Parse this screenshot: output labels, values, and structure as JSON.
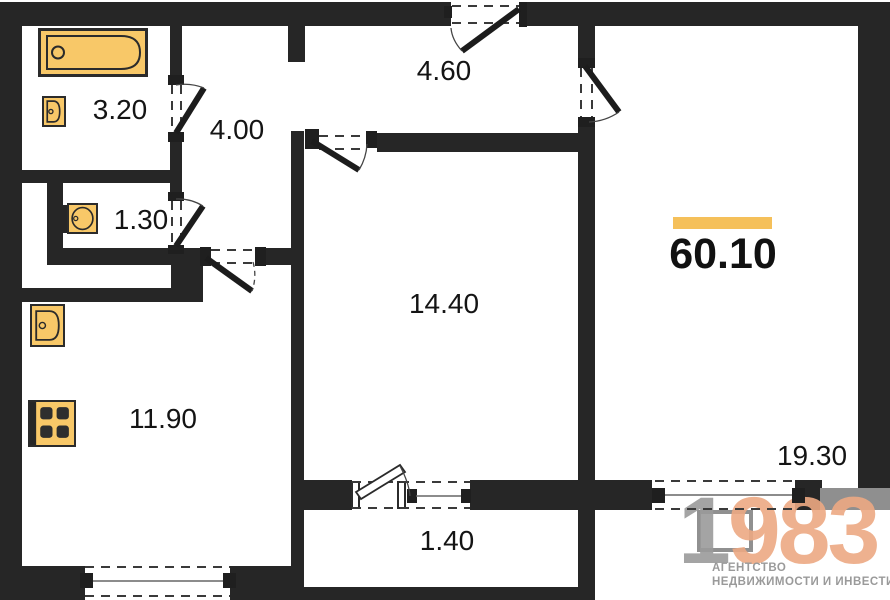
{
  "plan": {
    "rooms": [
      {
        "id": "bathroom",
        "area": "3.20"
      },
      {
        "id": "hallway",
        "area": "4.00"
      },
      {
        "id": "toilet",
        "area": "1.30"
      },
      {
        "id": "kitchen",
        "area": "11.90"
      },
      {
        "id": "living-room",
        "area": "14.40"
      },
      {
        "id": "corridor",
        "area": "4.60"
      },
      {
        "id": "bedroom",
        "area": "19.30"
      },
      {
        "id": "balcony",
        "area": "1.40"
      }
    ],
    "total_area": "60.10",
    "fixtures": [
      "bathtub-icon",
      "bath-sink-icon",
      "toilet-icon",
      "kitchen-sink-icon",
      "stove-icon"
    ]
  },
  "branding": {
    "logo_digit_gray": "1",
    "logo_digits_accent": "983",
    "tagline_line1": "АГЕНТСТВО",
    "tagline_line2": "НЕДВИЖИМОСТИ И ИНВЕСТИЦИЙ"
  },
  "colors": {
    "wall": "#262626",
    "fixture_fill": "#F8C868",
    "fixture_outline": "#2b2b2b",
    "accent_bar": "#F5C05A",
    "logo_gray": "#9B9B9B",
    "logo_accent": "#EDA983"
  }
}
